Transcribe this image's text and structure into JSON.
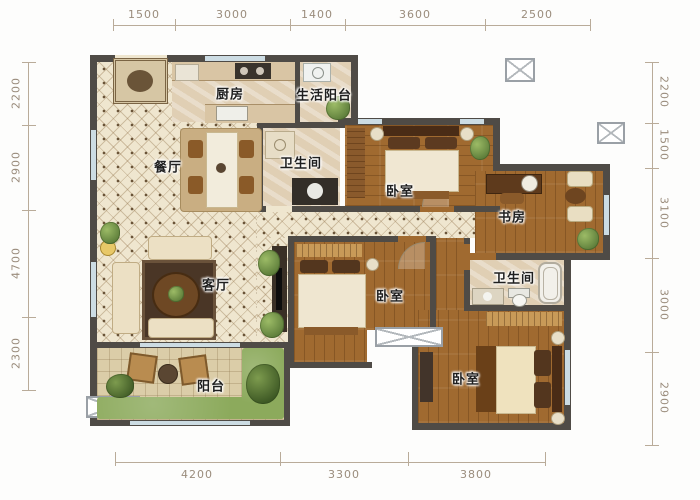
{
  "plan": {
    "type": "apartment-floor-plan",
    "units": "mm"
  },
  "dims": {
    "top": [
      "1500",
      "3000",
      "1400",
      "3600",
      "2500"
    ],
    "bottom": [
      "4200",
      "3300",
      "3800"
    ],
    "left": [
      "2200",
      "2900",
      "4700",
      "2300"
    ],
    "right": [
      "2200",
      "1500",
      "3100",
      "3000",
      "2900"
    ]
  },
  "rooms": {
    "kitchen": "厨房",
    "living_balcony": "生活阳台",
    "dining": "餐厅",
    "bath1": "卫生间",
    "bedroom1": "卧室",
    "study": "书房",
    "living": "客厅",
    "bedroom2": "卧室",
    "bath2": "卫生间",
    "bedroom3": "卧室",
    "balcony": "阳台"
  },
  "colors": {
    "wall": "#4f4b46",
    "tile_floor": "#efe6cf",
    "wood_floor": "#a06a30",
    "marble_floor": "#e0cfb4",
    "grass": "#8caa5c",
    "dimension_text": "#9a8c7c",
    "window": "#ccdce3"
  }
}
